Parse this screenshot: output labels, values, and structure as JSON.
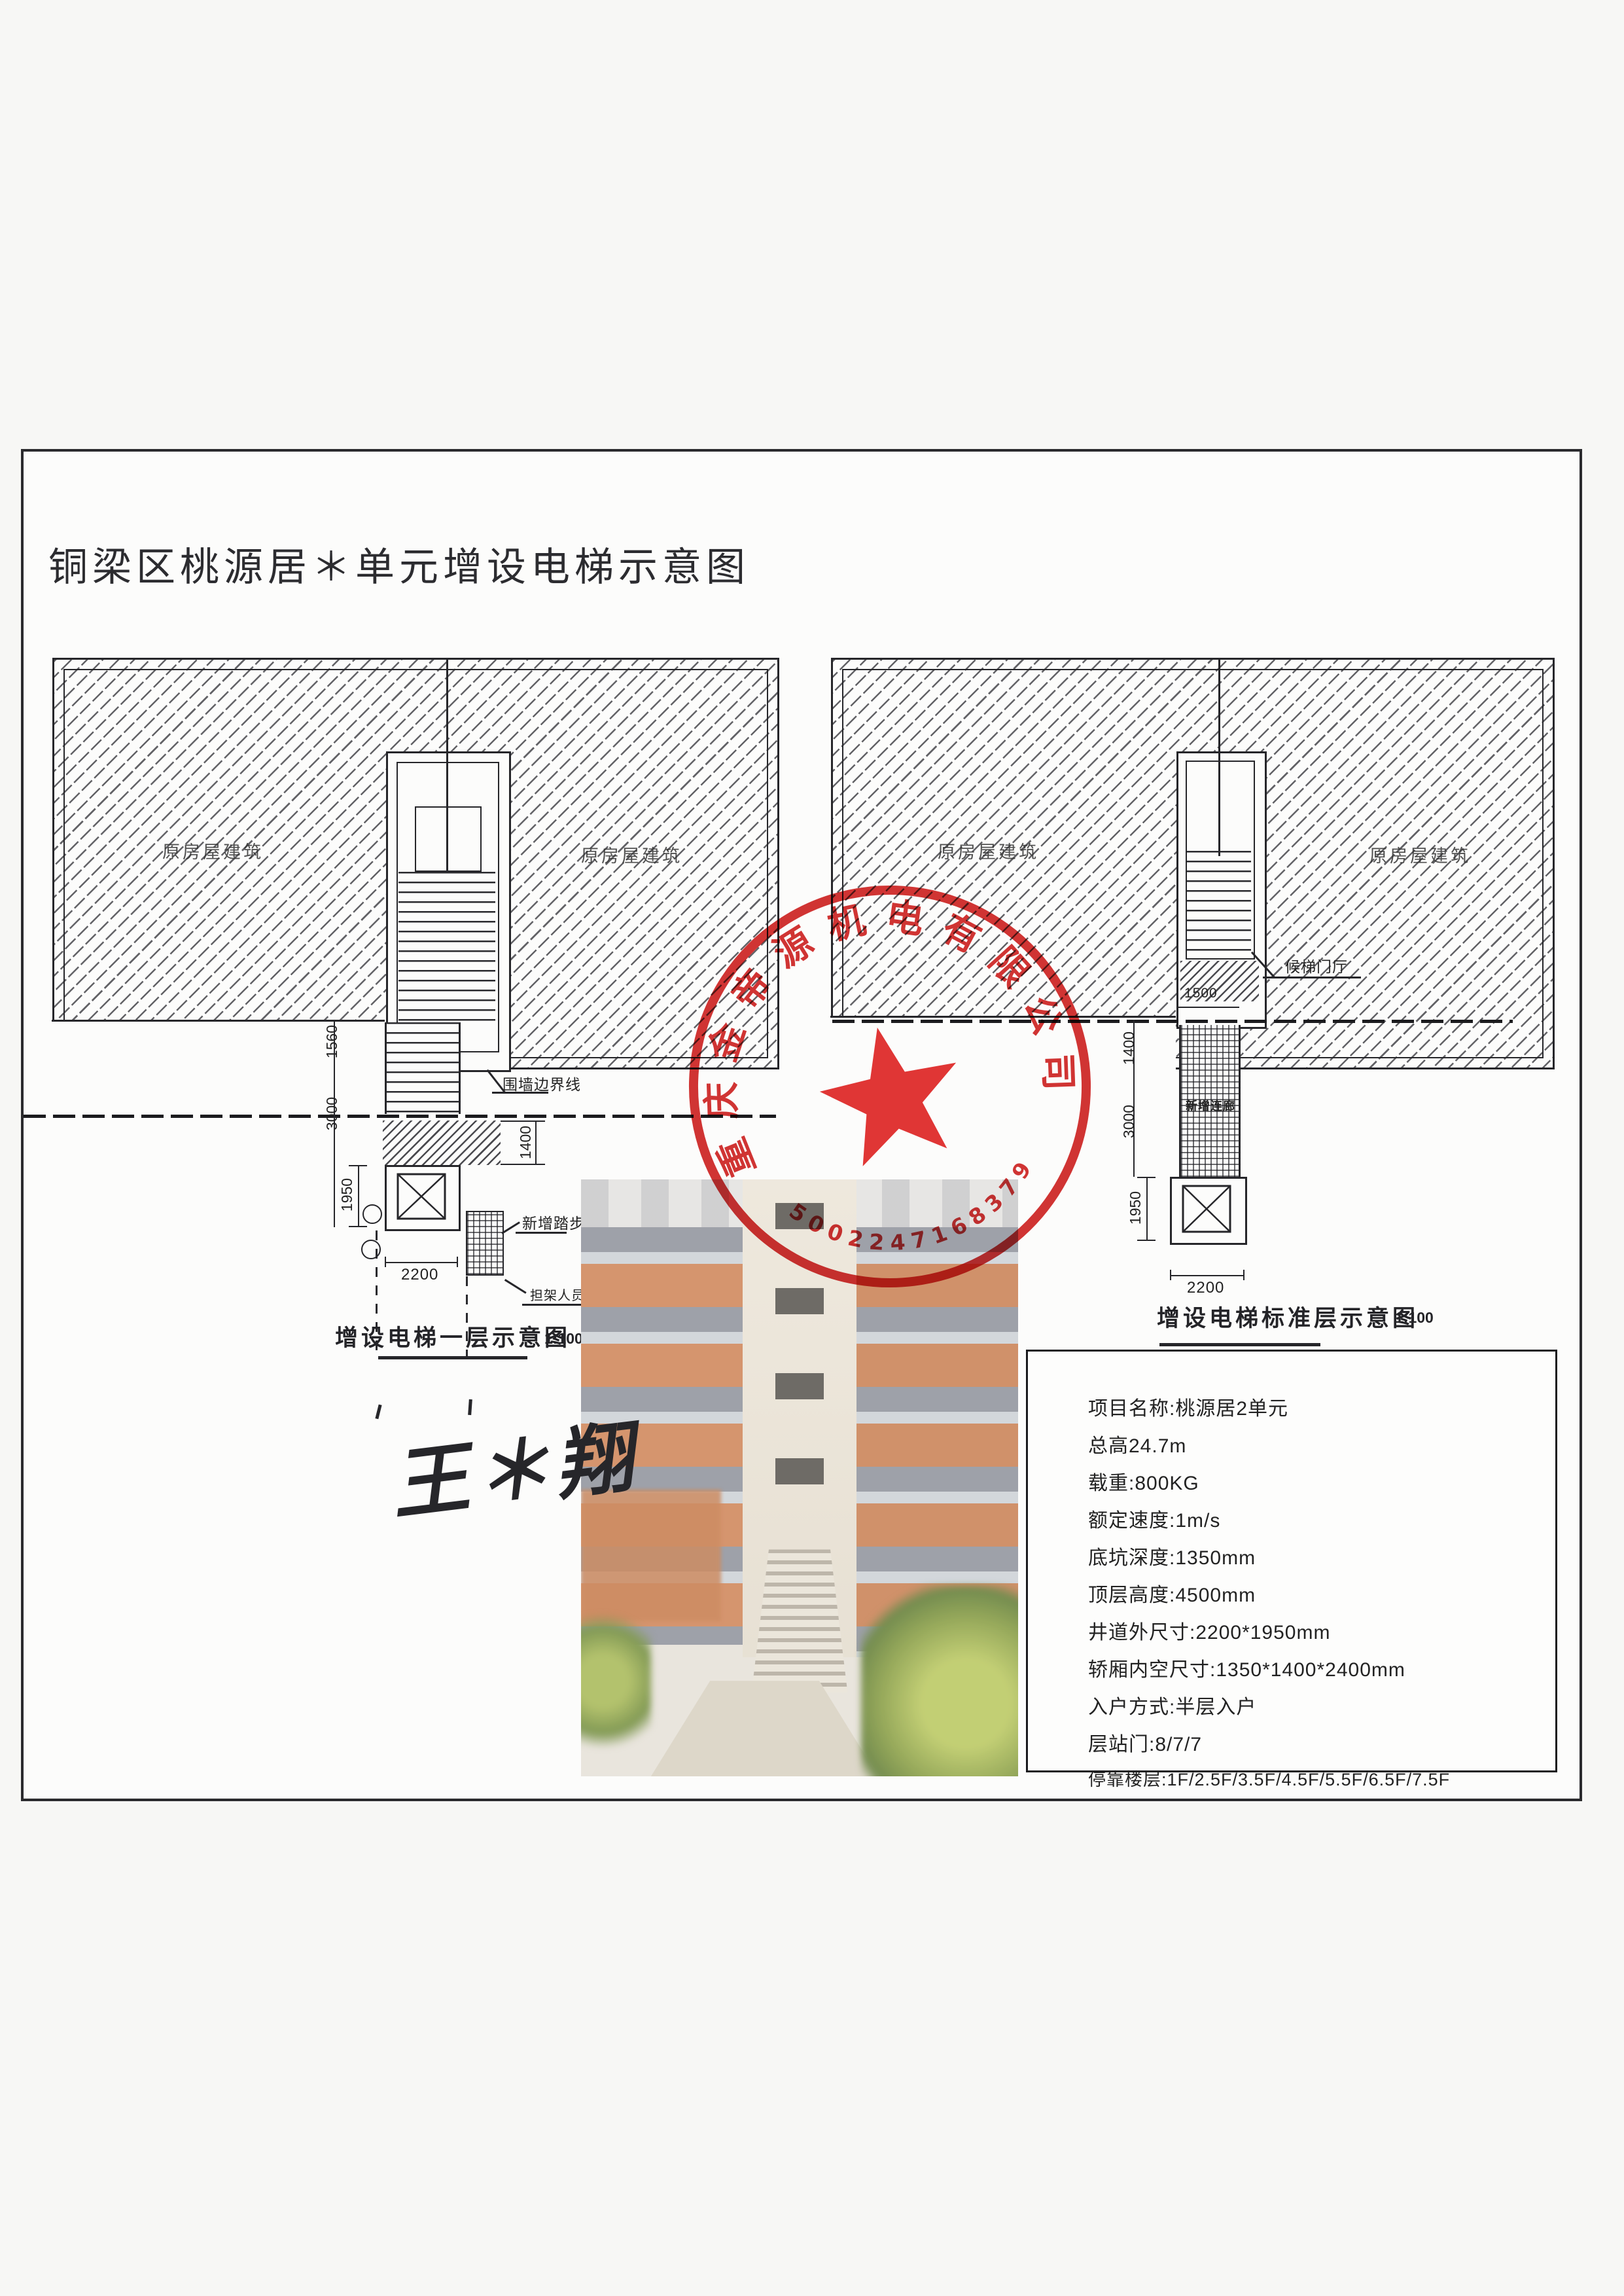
{
  "page": {
    "title": "铜梁区桃源居＊单元增设电梯示意图"
  },
  "left_plan": {
    "caption": "增设电梯一层示意图",
    "scale": "1:100",
    "label_building_left": "原房屋建筑",
    "label_building_right": "原房屋建筑",
    "dim_width": "2200",
    "dim_depth": "1950",
    "dim_platform": "1400",
    "dim_wall": "1560",
    "dim_offset": "3000",
    "leader_boundary": "围墙边界线",
    "leader_steps": "新增踏步",
    "leader_passage": "担架人员通道"
  },
  "right_plan": {
    "caption": "增设电梯标准层示意图",
    "scale": "1:100",
    "label_building_left": "原房屋建筑",
    "label_building_right": "原房屋建筑",
    "dim_width": "2200",
    "dim_depth": "1950",
    "dim_corridor_width": "1500",
    "dim_corridor_length": "3000",
    "dim_wall": "1400",
    "leader_hall": "候梯门厅",
    "label_corridor": "新增连廊"
  },
  "stamp": {
    "company": "重庆金帝源机电有限公司",
    "serial": "5002247168379",
    "color": "#cf1d1d"
  },
  "signature": {
    "name": "王＊翔"
  },
  "specs": {
    "lines": [
      "项目名称:桃源居2单元",
      "总高24.7m",
      "载重:800KG",
      "额定速度:1m/s",
      "底坑深度:1350mm",
      "顶层高度:4500mm",
      "井道外尺寸:2200*1950mm",
      "轿厢内空尺寸:1350*1400*2400mm",
      "入户方式:半层入户",
      "层站门:8/7/7",
      "停靠楼层:1F/2.5F/3.5F/4.5F/5.5F/6.5F/7.5F"
    ]
  }
}
